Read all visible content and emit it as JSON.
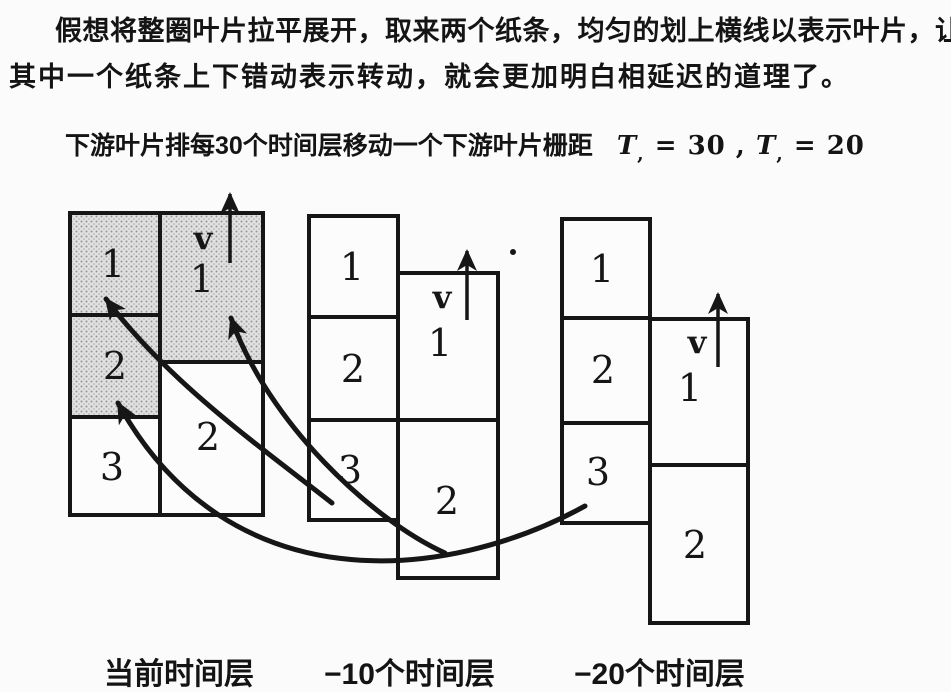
{
  "colors": {
    "ink": "#141414",
    "paper": "#fbfbfb"
  },
  "paragraph": {
    "line1": "假想将整圈叶片拉平展开，取来两个纸条，均匀的划上横线以表示叶片，让",
    "line2": "其中一个纸条上下错动表示转动，就会更加明白相延迟的道理了。"
  },
  "caption": {
    "text": "下游叶片排每30个时间层移动一个下游叶片栅距",
    "formula": {
      "var1": "T",
      "sub1": ",",
      "rhs1": " = 30 ,",
      "var2": "T",
      "sub2": ",",
      "rhs2": " = 20"
    }
  },
  "diagram": {
    "groups": [
      {
        "footer_label": "当前时间层",
        "v_label": "v",
        "stator_cells": [
          "1",
          "2",
          "3"
        ],
        "rotor_cells": [
          "1",
          "2"
        ]
      },
      {
        "footer_label": "−10个时间层",
        "v_label": "v",
        "stator_cells": [
          "1",
          "2",
          "3"
        ],
        "rotor_cells": [
          "1",
          "2"
        ]
      },
      {
        "footer_label": "−20个时间层",
        "v_label": "v",
        "stator_cells": [
          "1",
          "2",
          "3"
        ],
        "rotor_cells": [
          "1",
          "2"
        ]
      }
    ]
  }
}
